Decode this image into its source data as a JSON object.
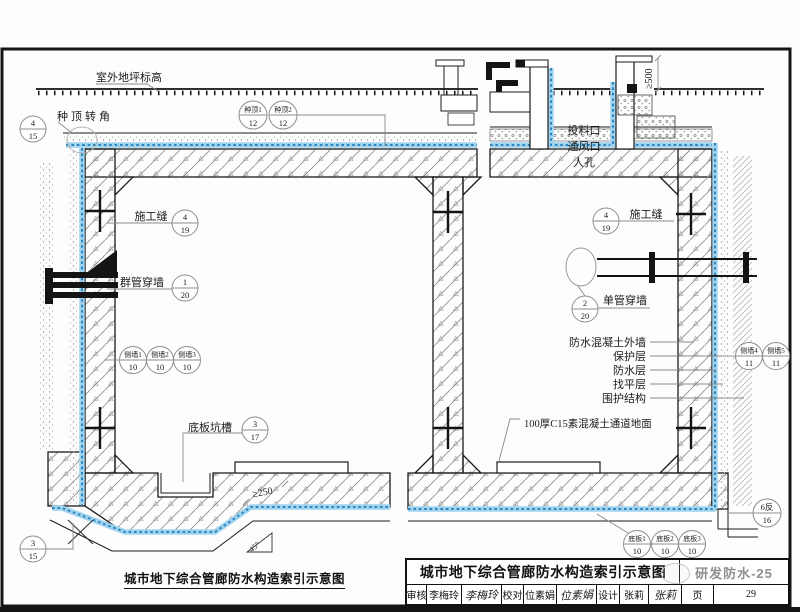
{
  "colors": {
    "membrane_light": "#9FD3EE",
    "membrane_dark": "#2E86C1",
    "line": "#1B1B1B"
  },
  "labels": {
    "ground": "室外地坪标高",
    "roof_corner": "种顶转角",
    "joint": "施工缝",
    "group_pipe": "群管穿墙",
    "single_pipe": "单管穿墙",
    "pit": "底板坑槽",
    "shaft": [
      "投料口",
      "通风口",
      "人孔"
    ],
    "layers": [
      "防水混凝土外墙",
      "保护层",
      "防水层",
      "找平层",
      "围护结构"
    ],
    "floor_note": "100厚C15素混凝土通道地面"
  },
  "dims": {
    "d500": "≥500",
    "d250": "≥250",
    "a45": "45°"
  },
  "callouts": {
    "roof_corner": {
      "top": "4",
      "bottom": "15"
    },
    "zhongding1": {
      "top": "种顶1",
      "bottom": "12"
    },
    "zhongding2": {
      "top": "种顶2",
      "bottom": "12"
    },
    "joint_left": {
      "top": "4",
      "bottom": "19"
    },
    "group_pipe": {
      "top": "1",
      "bottom": "20"
    },
    "cewall1": {
      "top": "侧墙1",
      "bottom": "10"
    },
    "cewall2": {
      "top": "侧墙2",
      "bottom": "10"
    },
    "cewall3": {
      "top": "侧墙3",
      "bottom": "10"
    },
    "pit": {
      "top": "3",
      "bottom": "17"
    },
    "corner_bl": {
      "top": "3",
      "bottom": "15"
    },
    "joint_right": {
      "top": "4",
      "bottom": "19"
    },
    "single_pipe": {
      "top": "2",
      "bottom": "20"
    },
    "cewall4": {
      "top": "侧墙4",
      "bottom": "11"
    },
    "cewall5": {
      "top": "侧墙5",
      "bottom": "11"
    },
    "fan6": {
      "top": "6反",
      "bottom": "16"
    },
    "diban1": {
      "top": "底板1",
      "bottom": "10"
    },
    "diban2": {
      "top": "底板2",
      "bottom": "10"
    },
    "diban3": {
      "top": "底板3",
      "bottom": "10"
    }
  },
  "caption": "城市地下综合管廊防水构造索引示意图",
  "titleblock": {
    "title": "城市地下综合管廊防水构造索引示意图",
    "doc_no": "研发防水-25",
    "review_label": "审核",
    "review_name": "李梅玲",
    "review_sig": "李梅玲",
    "proof_label": "校对",
    "proof_name": "位素娟",
    "proof_sig": "位素娟",
    "design_label": "设计",
    "design_name": "张莉",
    "design_sig": "张莉",
    "page_label": "页",
    "page_number": "29"
  }
}
